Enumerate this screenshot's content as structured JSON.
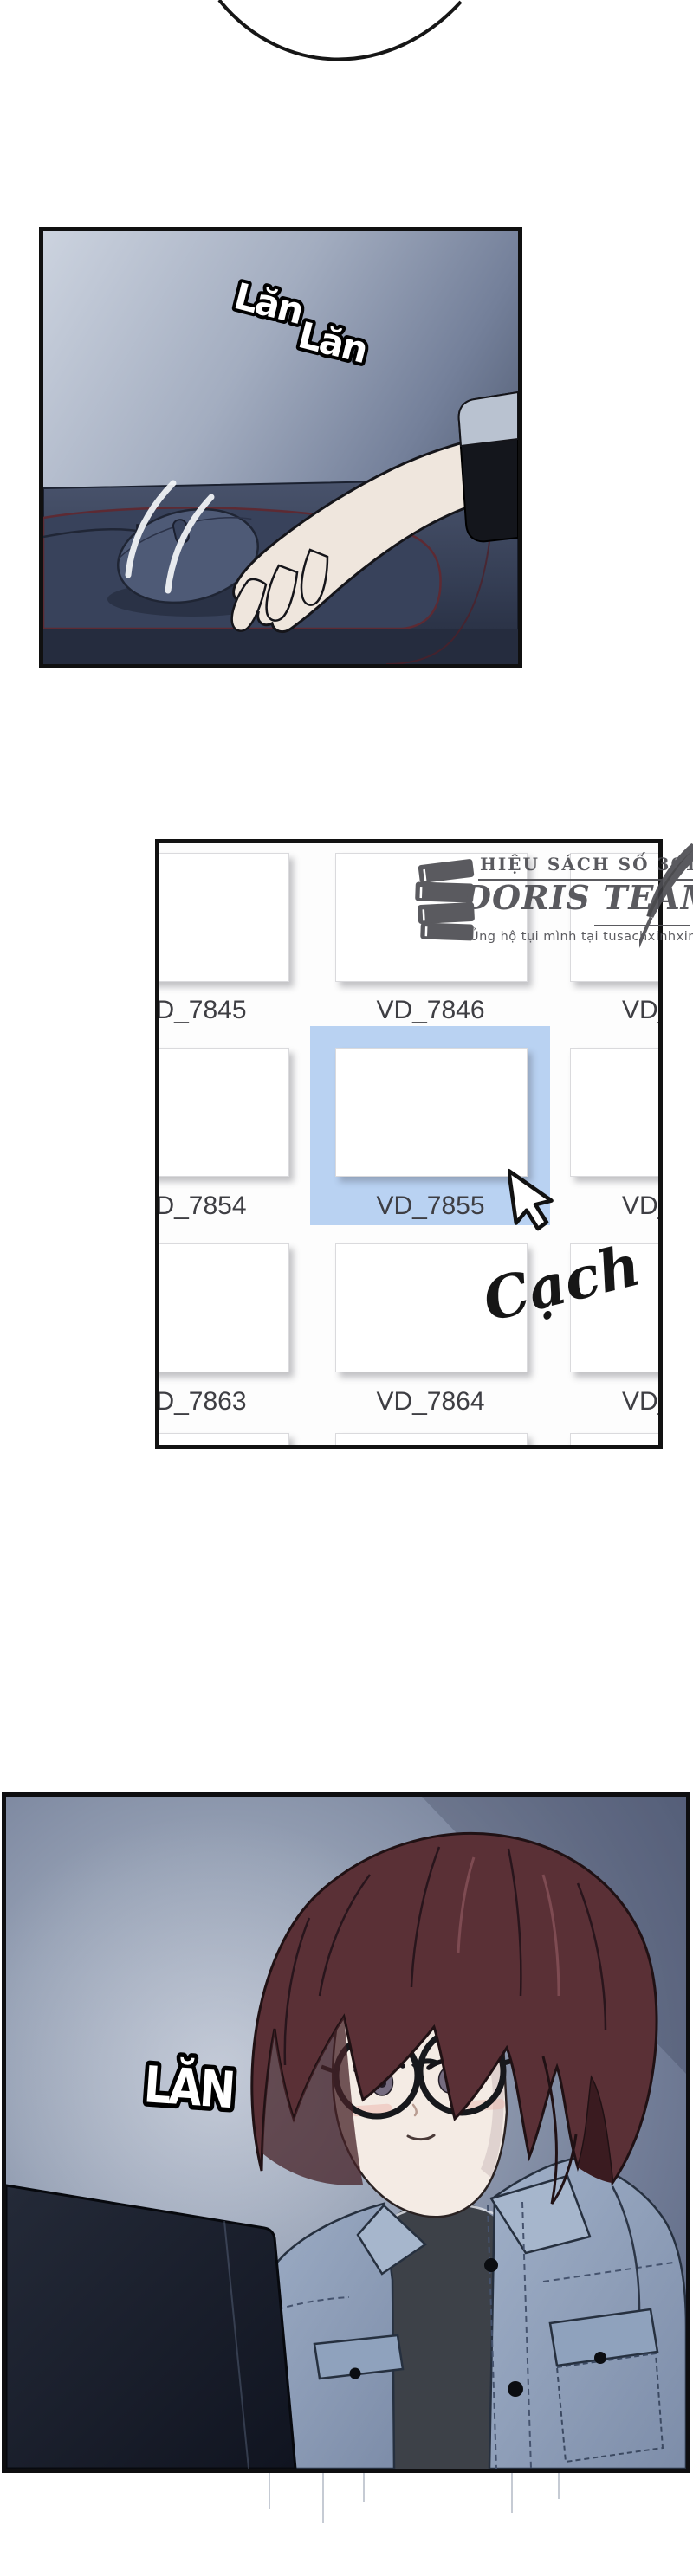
{
  "comic": {
    "sfx": {
      "panel1_scroll_a": "Lăn",
      "panel1_scroll_b": "Lăn",
      "panel2_click": "Cạch",
      "panel3_scroll": "LĂN"
    },
    "translator_watermark": {
      "tagline": "HIỆU SÁCH SỐ 3011",
      "team_name": "DORIS TEAM",
      "support_note": "Ủng hộ tụi mình tại tusachxinhxinh"
    },
    "file_browser": {
      "selected_file": "VD_7855",
      "rows": [
        {
          "cells": [
            {
              "label": "VD_7845"
            },
            {
              "label": "VD_7846"
            },
            {
              "label": "VD_"
            }
          ]
        },
        {
          "cells": [
            {
              "label": "VD_7854"
            },
            {
              "label": "VD_7855"
            },
            {
              "label": "VD_"
            }
          ]
        },
        {
          "cells": [
            {
              "label": "VD_7863"
            },
            {
              "label": "VD_7864"
            },
            {
              "label": "VD_"
            }
          ]
        }
      ]
    },
    "colors": {
      "selection_blue": "#b9d2f2",
      "label_gray": "#3e3e43",
      "panel1_wall": "#9aa5ba",
      "desk": "#3a445c",
      "mousepad_edge_red": "#5d2a33",
      "hair_brown": "#5a3036",
      "jacket_denim": "#9aabc4",
      "tee_dark": "#3d4148",
      "panel3_bg": "#707b95"
    }
  }
}
